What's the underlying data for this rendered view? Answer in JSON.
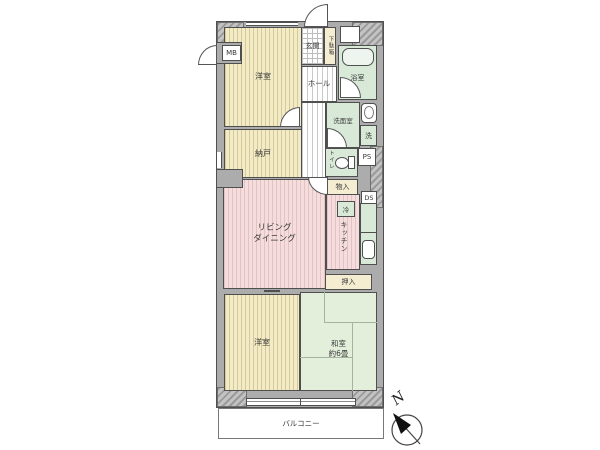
{
  "rooms": {
    "western_top": {
      "label": "洋室"
    },
    "nando": {
      "label": "納戸"
    },
    "living_dining": {
      "line1": "リビング",
      "line2": "ダイニング"
    },
    "western_bottom": {
      "label": "洋室"
    },
    "washitsu": {
      "line1": "和室",
      "line2": "約6畳"
    },
    "genkan": {
      "label": "玄関"
    },
    "getabako": {
      "label": "下駄箱"
    },
    "hall": {
      "label": "ホール"
    },
    "bath": {
      "label": "浴室"
    },
    "washroom": {
      "label": "洗面室"
    },
    "toilet": {
      "label": "トイレ"
    },
    "kitchen": {
      "label": "キッチン"
    },
    "monoire": {
      "label": "物入"
    },
    "oshiire": {
      "label": "押入"
    },
    "balcony": {
      "label": "バルコニー"
    }
  },
  "boxes": {
    "mb": "MB",
    "ps": "PS",
    "ds": "DS",
    "washer": "洗",
    "fridge": "冷"
  },
  "compass": {
    "north": "N"
  },
  "colors": {
    "wall_gray": "#acacac",
    "outline": "#4f4f4f",
    "room_yellow": "#f2ebc6",
    "room_pink": "#f6dddd",
    "room_green": "#d8e9d8",
    "tatami_green": "#e4efdb",
    "storage_yellow": "#f4edd2"
  }
}
